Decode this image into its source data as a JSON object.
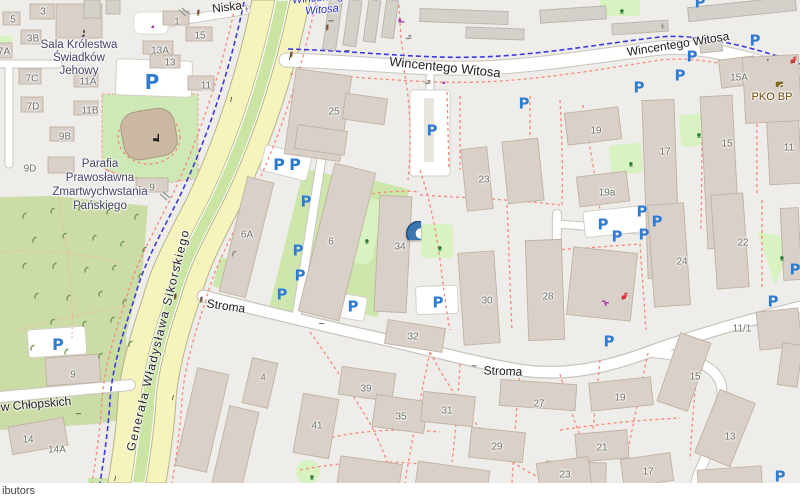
{
  "map": {
    "attribution": "ibutors",
    "parking_glyph": "P",
    "colors": {
      "bg": "#eeedea",
      "accent_parking": "#2f7bd0",
      "marker_blue": "#3b76b0",
      "road_yellow": "#f6f4bd",
      "median_green": "#c9e4a3",
      "park_green": "#cbdca6",
      "playground_green": "#d9f2c2",
      "building_fill": "#d9d0c9",
      "building_stroke": "#c0b2a2",
      "path_pink": "#f4897c",
      "cycle_blue": "#3b3bd9",
      "shop_magenta": "#ab39ab",
      "health_red": "#d23b3b",
      "bank_brown": "#7d6a1c",
      "road_white": "#ffffff",
      "road_casing": "#c9c5bc"
    },
    "marker": {
      "type": "marker",
      "x": 402,
      "y": 240,
      "s": 38,
      "anchor": "bottom"
    },
    "labels": [
      {
        "cls": "street",
        "text": "Niska",
        "x": 227,
        "y": 7,
        "rot": -7
      },
      {
        "cls": "street",
        "text": "Wincentego Witosa",
        "x": 445,
        "y": 67,
        "rot": 6,
        "s": 13
      },
      {
        "cls": "street",
        "text": "Wincentego Witosa",
        "x": 678,
        "y": 44,
        "rot": -9
      },
      {
        "cls": "street sikorskiego",
        "text": "Generała Władysława Sikorskiego",
        "x": 158,
        "y": 340,
        "rot": -76
      },
      {
        "cls": "street",
        "text": "Stroma",
        "x": 226,
        "y": 306,
        "rot": 8
      },
      {
        "cls": "street",
        "text": "Stroma",
        "x": 503,
        "y": 371,
        "rot": 2
      },
      {
        "cls": "street",
        "text": "w Chłopskich",
        "x": 36,
        "y": 404,
        "rot": -5
      },
      {
        "cls": "cycle",
        "text": "Wincentego",
        "x": 321,
        "y": -2,
        "rot": -5
      },
      {
        "cls": "cycle",
        "text": "Witosa",
        "x": 322,
        "y": 10,
        "rot": -5
      },
      {
        "cls": "poi",
        "text": "Sala Królestwa",
        "x": 79,
        "y": 45
      },
      {
        "cls": "poi",
        "text": "Świadków",
        "x": 79,
        "y": 58
      },
      {
        "cls": "poi",
        "text": "Jehowy",
        "x": 79,
        "y": 71
      },
      {
        "cls": "poi",
        "text": "Parafia",
        "x": 100,
        "y": 164
      },
      {
        "cls": "poi",
        "text": "Prawosławna",
        "x": 100,
        "y": 178
      },
      {
        "cls": "poi",
        "text": "Zmartwychwstania",
        "x": 100,
        "y": 192
      },
      {
        "cls": "poi",
        "text": "Pańskiego",
        "x": 100,
        "y": 206
      },
      {
        "cls": "bank",
        "text": "PKO BP",
        "x": 772,
        "y": 97
      },
      {
        "cls": "bnum",
        "text": "3",
        "x": 43,
        "y": 12
      },
      {
        "cls": "bnum",
        "text": "5",
        "x": 13,
        "y": 20
      },
      {
        "cls": "bnum",
        "text": "3B",
        "x": 33,
        "y": 39
      },
      {
        "cls": "bnum",
        "text": "7A",
        "x": 4,
        "y": 52
      },
      {
        "cls": "bnum",
        "text": "7C",
        "x": 32,
        "y": 79
      },
      {
        "cls": "bnum",
        "text": "7D",
        "x": 33,
        "y": 107
      },
      {
        "cls": "bnum",
        "text": "11A",
        "x": 88,
        "y": 82
      },
      {
        "cls": "bnum",
        "text": "11B",
        "x": 90,
        "y": 111
      },
      {
        "cls": "bnum",
        "text": "9B",
        "x": 65,
        "y": 137
      },
      {
        "cls": "bnum",
        "text": "9D",
        "x": 30,
        "y": 169
      },
      {
        "cls": "bnum",
        "text": "9",
        "x": 152,
        "y": 188
      },
      {
        "cls": "bnum",
        "text": "1",
        "x": 177,
        "y": 22
      },
      {
        "cls": "bnum",
        "text": "15",
        "x": 200,
        "y": 36
      },
      {
        "cls": "bnum",
        "text": "13A",
        "x": 160,
        "y": 51
      },
      {
        "cls": "bnum",
        "text": "13",
        "x": 170,
        "y": 63
      },
      {
        "cls": "bnum",
        "text": "11",
        "x": 206,
        "y": 86
      },
      {
        "cls": "bnum",
        "text": "25",
        "x": 334,
        "y": 112
      },
      {
        "cls": "bnum",
        "text": "6A",
        "x": 247,
        "y": 235
      },
      {
        "cls": "bnum",
        "text": "6",
        "x": 331,
        "y": 242
      },
      {
        "cls": "bnum",
        "text": "34",
        "x": 400,
        "y": 247
      },
      {
        "cls": "bnum",
        "text": "32",
        "x": 413,
        "y": 337
      },
      {
        "cls": "bnum",
        "text": "30",
        "x": 487,
        "y": 301
      },
      {
        "cls": "bnum",
        "text": "28",
        "x": 548,
        "y": 297
      },
      {
        "cls": "bnum",
        "text": "23",
        "x": 484,
        "y": 180
      },
      {
        "cls": "bnum",
        "text": "19",
        "x": 596,
        "y": 131
      },
      {
        "cls": "bnum",
        "text": "19a",
        "x": 607,
        "y": 193
      },
      {
        "cls": "bnum",
        "text": "17",
        "x": 665,
        "y": 152
      },
      {
        "cls": "bnum",
        "text": "15",
        "x": 727,
        "y": 144
      },
      {
        "cls": "bnum",
        "text": "11",
        "x": 789,
        "y": 148
      },
      {
        "cls": "bnum",
        "text": "15A",
        "x": 739,
        "y": 78
      },
      {
        "cls": "bnum",
        "text": "24",
        "x": 682,
        "y": 262
      },
      {
        "cls": "bnum",
        "text": "22",
        "x": 743,
        "y": 243
      },
      {
        "cls": "bnum",
        "text": "11/1",
        "x": 742,
        "y": 329
      },
      {
        "cls": "bnum",
        "text": "39",
        "x": 366,
        "y": 389
      },
      {
        "cls": "bnum",
        "text": "41",
        "x": 317,
        "y": 426
      },
      {
        "cls": "bnum",
        "text": "35",
        "x": 401,
        "y": 417
      },
      {
        "cls": "bnum",
        "text": "31",
        "x": 447,
        "y": 411
      },
      {
        "cls": "bnum",
        "text": "29",
        "x": 497,
        "y": 447
      },
      {
        "cls": "bnum",
        "text": "27",
        "x": 539,
        "y": 404
      },
      {
        "cls": "bnum",
        "text": "19",
        "x": 620,
        "y": 398
      },
      {
        "cls": "bnum",
        "text": "21",
        "x": 602,
        "y": 448
      },
      {
        "cls": "bnum",
        "text": "23",
        "x": 565,
        "y": 475
      },
      {
        "cls": "bnum",
        "text": "17",
        "x": 648,
        "y": 472
      },
      {
        "cls": "bnum",
        "text": "15",
        "x": 695,
        "y": 377
      },
      {
        "cls": "bnum",
        "text": "13",
        "x": 730,
        "y": 437
      },
      {
        "cls": "bnum",
        "text": "9",
        "x": 73,
        "y": 375
      },
      {
        "cls": "bnum",
        "text": "14",
        "x": 28,
        "y": 440
      },
      {
        "cls": "bnum",
        "text": "14A",
        "x": 57,
        "y": 450
      },
      {
        "cls": "bnum",
        "text": "4",
        "x": 263,
        "y": 378
      }
    ],
    "parking": [
      {
        "x": 152,
        "y": 82,
        "s": 20
      },
      {
        "x": 432,
        "y": 131,
        "s": 15
      },
      {
        "x": 524,
        "y": 104,
        "s": 15
      },
      {
        "x": 279,
        "y": 165,
        "s": 16
      },
      {
        "x": 295,
        "y": 165,
        "s": 16
      },
      {
        "x": 306,
        "y": 202,
        "s": 15
      },
      {
        "x": 298,
        "y": 251,
        "s": 15
      },
      {
        "x": 300,
        "y": 276,
        "s": 15
      },
      {
        "x": 282,
        "y": 295,
        "s": 15
      },
      {
        "x": 353,
        "y": 307,
        "s": 15
      },
      {
        "x": 438,
        "y": 303,
        "s": 15
      },
      {
        "x": 58,
        "y": 345,
        "s": 16
      },
      {
        "x": 603,
        "y": 225,
        "s": 15
      },
      {
        "x": 642,
        "y": 212,
        "s": 15
      },
      {
        "x": 657,
        "y": 222,
        "s": 15
      },
      {
        "x": 617,
        "y": 237,
        "s": 15
      },
      {
        "x": 644,
        "y": 235,
        "s": 15
      },
      {
        "x": 609,
        "y": 342,
        "s": 15
      },
      {
        "x": 773,
        "y": 302,
        "s": 15
      },
      {
        "x": 795,
        "y": 270,
        "s": 15
      },
      {
        "x": 780,
        "y": 477,
        "s": 15
      },
      {
        "x": 700,
        "y": 3,
        "s": 15
      },
      {
        "x": 755,
        "y": 41,
        "s": 15
      },
      {
        "x": 692,
        "y": 57,
        "s": 15
      },
      {
        "x": 680,
        "y": 76,
        "s": 15
      },
      {
        "x": 639,
        "y": 88,
        "s": 15
      }
    ],
    "icons": [
      {
        "type": "tree",
        "x": 20,
        "y": 212
      },
      {
        "type": "tree",
        "x": 48,
        "y": 207
      },
      {
        "type": "tree",
        "x": 76,
        "y": 204
      },
      {
        "type": "tree",
        "x": 104,
        "y": 208
      },
      {
        "type": "tree",
        "x": 132,
        "y": 213
      },
      {
        "type": "tree",
        "x": 30,
        "y": 236
      },
      {
        "type": "tree",
        "x": 60,
        "y": 232
      },
      {
        "type": "tree",
        "x": 90,
        "y": 234
      },
      {
        "type": "tree",
        "x": 118,
        "y": 240
      },
      {
        "type": "tree",
        "x": 140,
        "y": 246
      },
      {
        "type": "tree",
        "x": 20,
        "y": 262
      },
      {
        "type": "tree",
        "x": 50,
        "y": 262
      },
      {
        "type": "tree",
        "x": 82,
        "y": 266
      },
      {
        "type": "tree",
        "x": 110,
        "y": 264
      },
      {
        "type": "tree",
        "x": 136,
        "y": 272
      },
      {
        "type": "tree",
        "x": 32,
        "y": 292
      },
      {
        "type": "tree",
        "x": 64,
        "y": 294
      },
      {
        "type": "tree",
        "x": 96,
        "y": 290
      },
      {
        "type": "tree",
        "x": 120,
        "y": 298
      },
      {
        "type": "tree",
        "x": 48,
        "y": 318
      },
      {
        "type": "tree",
        "x": 80,
        "y": 320
      },
      {
        "type": "tree",
        "x": 108,
        "y": 316
      },
      {
        "type": "tree",
        "x": 28,
        "y": 344
      },
      {
        "type": "tree",
        "x": 62,
        "y": 348
      },
      {
        "type": "tree",
        "x": 96,
        "y": 352
      },
      {
        "type": "tree",
        "x": 126,
        "y": 340
      },
      {
        "type": "playground",
        "x": 363,
        "y": 237
      },
      {
        "type": "playground",
        "x": 436,
        "y": 244
      },
      {
        "type": "playground",
        "x": 695,
        "y": 131
      },
      {
        "type": "playground",
        "x": 627,
        "y": 160
      },
      {
        "type": "playground",
        "x": 778,
        "y": 254
      },
      {
        "type": "playground",
        "x": 308,
        "y": 473
      },
      {
        "type": "playground",
        "x": 618,
        "y": 7
      },
      {
        "type": "traffic-light",
        "x": 193,
        "y": 9
      },
      {
        "type": "traffic-light",
        "x": 322,
        "y": 24
      },
      {
        "type": "traffic-light",
        "x": 286,
        "y": 51
      },
      {
        "type": "traffic-light",
        "x": 170,
        "y": 293
      },
      {
        "type": "traffic-light",
        "x": 196,
        "y": 296
      },
      {
        "type": "picnic",
        "x": 405,
        "y": 33
      },
      {
        "type": "picnic",
        "x": 424,
        "y": 78
      },
      {
        "type": "ladder",
        "x": 242,
        "y": 5
      },
      {
        "type": "ladder",
        "x": 658,
        "y": 22
      },
      {
        "type": "shelter",
        "x": 230,
        "y": 250
      },
      {
        "type": "cart",
        "x": 601,
        "y": 298,
        "s": 16
      },
      {
        "type": "medkit",
        "x": 620,
        "y": 292,
        "s": 15
      },
      {
        "type": "medkit",
        "x": 789,
        "y": 56,
        "s": 15
      },
      {
        "type": "bank",
        "x": 775,
        "y": 79,
        "s": 16
      },
      {
        "type": "worship",
        "x": 77,
        "y": 29,
        "s": 15
      },
      {
        "type": "cross",
        "x": 150,
        "y": 133,
        "s": 18
      },
      {
        "type": "fitness",
        "x": 397,
        "y": 15,
        "s": 15
      },
      {
        "type": "dot-magenta",
        "x": 441,
        "y": 80,
        "s": 8
      },
      {
        "type": "dot-purple",
        "x": 150,
        "y": 24,
        "s": 8
      },
      {
        "type": "dot-black",
        "x": 766,
        "y": 58,
        "s": 5
      },
      {
        "type": "arrow",
        "x": 335,
        "y": 27,
        "rot": 180
      },
      {
        "type": "arrow",
        "x": 344,
        "y": 44,
        "rot": 5
      },
      {
        "type": "arrow",
        "x": 238,
        "y": 97,
        "rot": 103
      },
      {
        "type": "arrow",
        "x": 283,
        "y": 60,
        "rot": -78
      },
      {
        "type": "arrow",
        "x": 181,
        "y": 262,
        "rot": 103
      },
      {
        "type": "arrow",
        "x": 166,
        "y": 400,
        "rot": -77
      },
      {
        "type": "arrow",
        "x": 122,
        "y": 476,
        "rot": 103
      },
      {
        "type": "arrow",
        "x": 325,
        "y": 330,
        "rot": 185
      },
      {
        "type": "arrow",
        "x": 478,
        "y": 372,
        "rot": 180
      },
      {
        "type": "arrow",
        "x": 74,
        "y": 408,
        "rot": -5
      }
    ]
  }
}
